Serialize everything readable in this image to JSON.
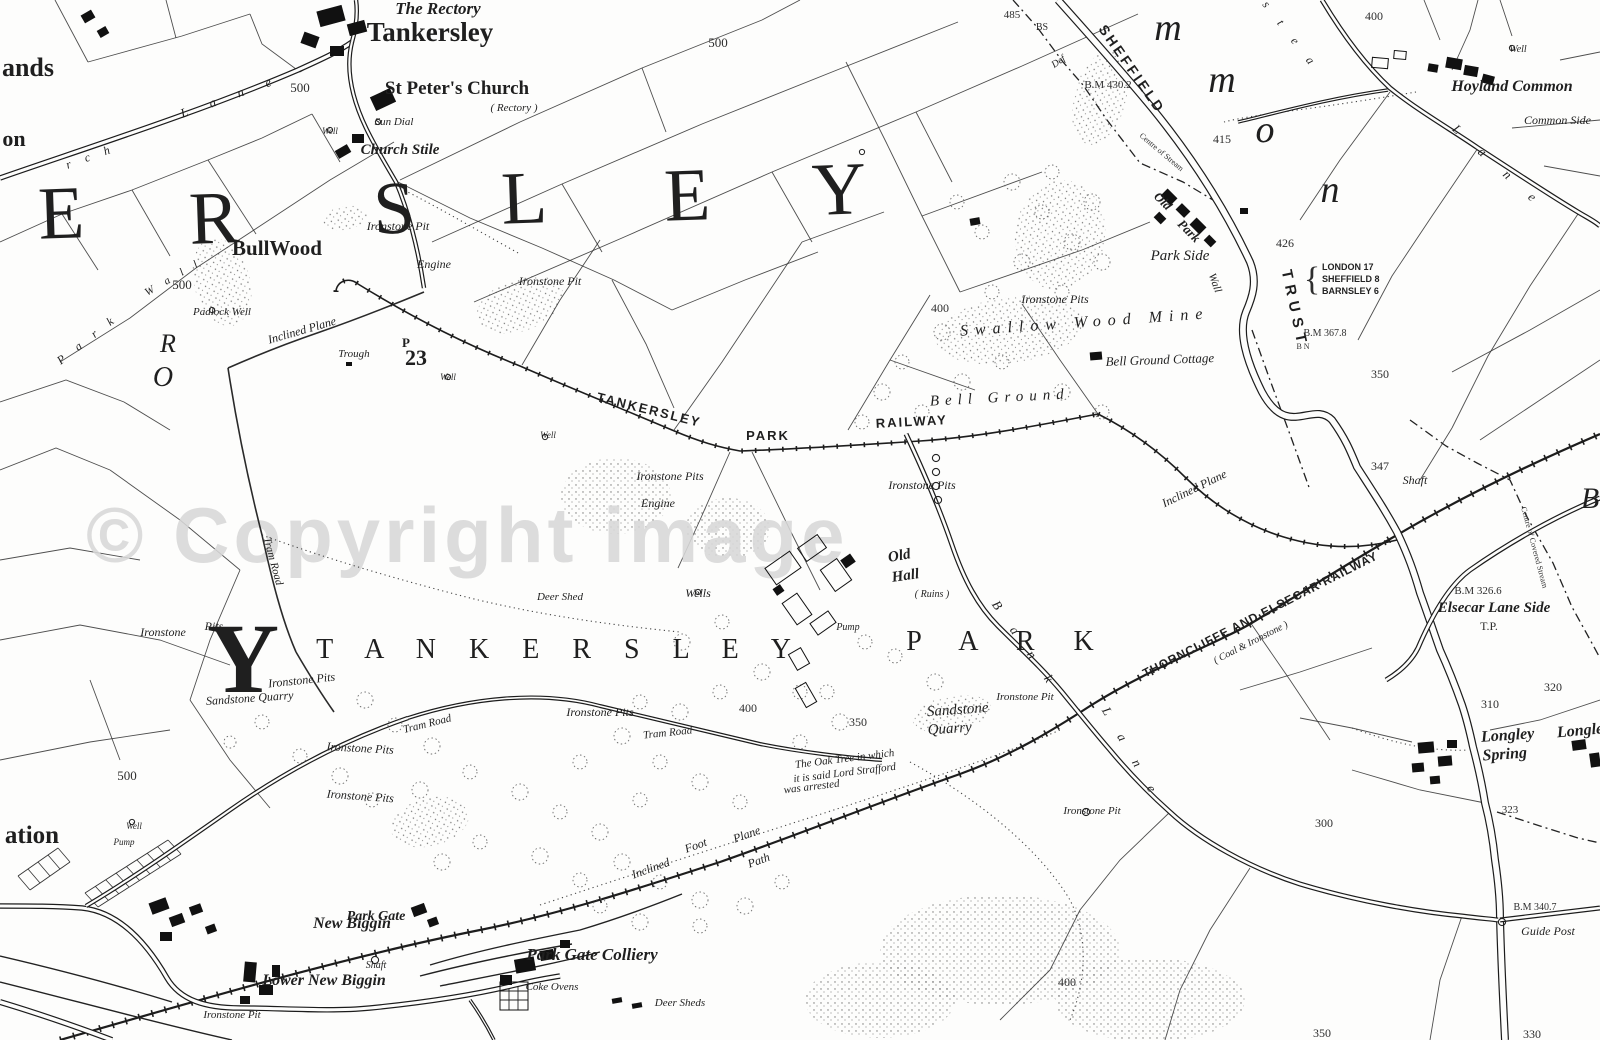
{
  "map": {
    "watermark": "© Copyright image",
    "labels": [
      {
        "t": "The Rectory",
        "x": 438,
        "y": 14,
        "s": "g",
        "f": 17
      },
      {
        "t": "Tankersley",
        "x": 430,
        "y": 41,
        "s": "n",
        "f": 27
      },
      {
        "t": "St Peter's Church",
        "x": 457,
        "y": 94,
        "s": "n",
        "f": 19
      },
      {
        "t": "( Rectory )",
        "x": 514,
        "y": 111,
        "s": "i",
        "f": 11
      },
      {
        "t": "Sun Dial",
        "x": 394,
        "y": 125,
        "s": "i",
        "f": 11
      },
      {
        "t": "Well",
        "x": 330,
        "y": 134,
        "s": "i",
        "f": 9
      },
      {
        "t": "Church Stile",
        "x": 400,
        "y": 154,
        "s": "g",
        "f": 15
      },
      {
        "t": "ands",
        "x": 28,
        "y": 76,
        "s": "n",
        "f": 26
      },
      {
        "t": "on",
        "x": 14,
        "y": 146,
        "s": "n",
        "f": 22
      },
      {
        "t": "E",
        "x": 62,
        "y": 238,
        "s": "B",
        "f": 75,
        "r": -2
      },
      {
        "t": "R",
        "x": 215,
        "y": 243,
        "s": "B",
        "f": 75,
        "r": -2
      },
      {
        "t": "S",
        "x": 395,
        "y": 233,
        "s": "B",
        "f": 75,
        "r": -2
      },
      {
        "t": "L",
        "x": 525,
        "y": 223,
        "s": "B",
        "f": 75,
        "r": -2
      },
      {
        "t": "E",
        "x": 688,
        "y": 220,
        "s": "B",
        "f": 75,
        "r": -2
      },
      {
        "t": "Y",
        "x": 840,
        "y": 214,
        "s": "B",
        "f": 75,
        "r": -2
      },
      {
        "t": "m",
        "x": 1168,
        "y": 40,
        "s": "Bi",
        "f": 38
      },
      {
        "t": "m",
        "x": 1222,
        "y": 92,
        "s": "Bi",
        "f": 38
      },
      {
        "t": "o",
        "x": 1265,
        "y": 142,
        "s": "Bi",
        "f": 38
      },
      {
        "t": "n",
        "x": 1330,
        "y": 202,
        "s": "Bi",
        "f": 38
      },
      {
        "t": "500",
        "x": 300,
        "y": 92,
        "s": "m",
        "f": 13
      },
      {
        "t": "500",
        "x": 718,
        "y": 47,
        "s": "m",
        "f": 13
      },
      {
        "t": "485",
        "x": 1012,
        "y": 18,
        "s": "m",
        "f": 11
      },
      {
        "t": "400",
        "x": 1374,
        "y": 20,
        "s": "m",
        "f": 12
      },
      {
        "t": "Well",
        "x": 1518,
        "y": 52,
        "s": "i",
        "f": 10
      },
      {
        "t": "Hoyland Common",
        "x": 1512,
        "y": 91,
        "s": "g",
        "f": 16
      },
      {
        "t": "Common Side",
        "x": 1524,
        "y": 124,
        "s": "i",
        "f": 12,
        "a": "s"
      },
      {
        "t": "BS",
        "x": 1042,
        "y": 30,
        "s": "m",
        "f": 10
      },
      {
        "t": "Def",
        "x": 1060,
        "y": 64,
        "s": "i",
        "f": 10,
        "r": -35
      },
      {
        "t": "B.M 430.2",
        "x": 1108,
        "y": 88,
        "s": "m",
        "f": 11
      },
      {
        "t": "SHEFFIELD",
        "x": 1128,
        "y": 72,
        "s": "r",
        "f": 14,
        "r": 55,
        "ls": 3
      },
      {
        "t": "415",
        "x": 1222,
        "y": 143,
        "s": "m",
        "f": 12
      },
      {
        "t": "Centre of Stream",
        "x": 1160,
        "y": 154,
        "s": "m",
        "f": 8,
        "r": 40
      },
      {
        "t": "426",
        "x": 1285,
        "y": 247,
        "s": "m",
        "f": 12
      },
      {
        "t": "TRUST",
        "x": 1290,
        "y": 310,
        "s": "r",
        "f": 15,
        "r": 78,
        "ls": 6
      },
      {
        "t": "{",
        "x": 1312,
        "y": 290,
        "s": "m",
        "f": 34
      },
      {
        "t": "LONDON 17",
        "x": 1322,
        "y": 270,
        "s": "r0",
        "f": 9,
        "a": "s"
      },
      {
        "t": "SHEFFIELD 8",
        "x": 1322,
        "y": 282,
        "s": "r0",
        "f": 9,
        "a": "s"
      },
      {
        "t": "BARNSLEY 6",
        "x": 1322,
        "y": 294,
        "s": "r0",
        "f": 9,
        "a": "s"
      },
      {
        "t": "B.M 367.8",
        "x": 1325,
        "y": 336,
        "s": "m",
        "f": 10
      },
      {
        "t": "B N",
        "x": 1303,
        "y": 349,
        "s": "m",
        "f": 8
      },
      {
        "t": "350",
        "x": 1380,
        "y": 378,
        "s": "m",
        "f": 12
      },
      {
        "t": "Old",
        "x": 1160,
        "y": 204,
        "s": "g",
        "f": 13,
        "r": 45
      },
      {
        "t": "Park",
        "x": 1186,
        "y": 234,
        "s": "g",
        "f": 13,
        "r": 45
      },
      {
        "t": "Wall",
        "x": 1212,
        "y": 284,
        "s": "i",
        "f": 11,
        "r": 70
      },
      {
        "t": "Park Side",
        "x": 1180,
        "y": 260,
        "s": "i",
        "f": 15
      },
      {
        "t": "Ironstone Pits",
        "x": 1055,
        "y": 303,
        "s": "i",
        "f": 12
      },
      {
        "t": "Swallow Wood Mine",
        "x": 1085,
        "y": 327,
        "s": "iS",
        "f": 16,
        "ls": 7,
        "r": -4
      },
      {
        "t": "Bell Ground Cottage",
        "x": 1160,
        "y": 364,
        "s": "i",
        "f": 13,
        "r": -2
      },
      {
        "t": "Bell Ground",
        "x": 1000,
        "y": 402,
        "s": "iS",
        "f": 15,
        "ls": 6,
        "r": -3
      },
      {
        "t": "400",
        "x": 940,
        "y": 312,
        "s": "m",
        "f": 12
      },
      {
        "t": "500",
        "x": 182,
        "y": 289,
        "s": "m",
        "f": 13
      },
      {
        "t": "BullWood",
        "x": 277,
        "y": 255,
        "s": "n",
        "f": 21
      },
      {
        "t": "Padlock Well",
        "x": 222,
        "y": 315,
        "s": "i",
        "f": 11
      },
      {
        "t": "R",
        "x": 168,
        "y": 352,
        "s": "Bi",
        "f": 26
      },
      {
        "t": "O",
        "x": 163,
        "y": 386,
        "s": "Bi",
        "f": 28
      },
      {
        "t": "Ironstone Pit",
        "x": 398,
        "y": 230,
        "s": "i",
        "f": 12
      },
      {
        "t": "Engine",
        "x": 434,
        "y": 268,
        "s": "i",
        "f": 12
      },
      {
        "t": "Ironstone Pit",
        "x": 550,
        "y": 285,
        "s": "i",
        "f": 12
      },
      {
        "t": "Inclined Plane",
        "x": 303,
        "y": 334,
        "s": "i",
        "f": 12,
        "r": -16
      },
      {
        "t": "Trough",
        "x": 354,
        "y": 357,
        "s": "i",
        "f": 11
      },
      {
        "t": "P",
        "x": 406,
        "y": 347,
        "s": "n",
        "f": 13
      },
      {
        "t": "23",
        "x": 416,
        "y": 365,
        "s": "n",
        "f": 22
      },
      {
        "t": "Well",
        "x": 448,
        "y": 380,
        "s": "i",
        "f": 9
      },
      {
        "t": "Well",
        "x": 548,
        "y": 438,
        "s": "i",
        "f": 9
      },
      {
        "t": "TANKERSLEY",
        "x": 648,
        "y": 414,
        "s": "r",
        "f": 13,
        "r": 14,
        "ls": 2
      },
      {
        "t": "PARK",
        "x": 768,
        "y": 440,
        "s": "r",
        "f": 13,
        "ls": 2
      },
      {
        "t": "RAILWAY",
        "x": 912,
        "y": 426,
        "s": "r",
        "f": 13,
        "r": -3,
        "ls": 2
      },
      {
        "t": "Ironstone Pits",
        "x": 670,
        "y": 480,
        "s": "i",
        "f": 12
      },
      {
        "t": "Engine",
        "x": 658,
        "y": 507,
        "s": "i",
        "f": 12
      },
      {
        "t": "Ironstone Pits",
        "x": 922,
        "y": 489,
        "s": "i",
        "f": 12
      },
      {
        "t": "Old",
        "x": 900,
        "y": 560,
        "s": "g",
        "f": 15,
        "r": -10
      },
      {
        "t": "Hall",
        "x": 906,
        "y": 580,
        "s": "g",
        "f": 15,
        "r": -8
      },
      {
        "t": "( Ruins )",
        "x": 932,
        "y": 597,
        "s": "i",
        "f": 10
      },
      {
        "t": "Wells",
        "x": 698,
        "y": 597,
        "s": "i",
        "f": 12
      },
      {
        "t": "Deer Shed",
        "x": 560,
        "y": 600,
        "s": "i",
        "f": 11
      },
      {
        "t": "Pump",
        "x": 848,
        "y": 630,
        "s": "i",
        "f": 10
      },
      {
        "t": "Y",
        "x": 243,
        "y": 692,
        "s": "Y",
        "f": 100
      },
      {
        "t": "T A N K E R S L E Y",
        "x": 560,
        "y": 658,
        "s": "S",
        "f": 28,
        "ls": 13
      },
      {
        "t": "P A R K",
        "x": 1008,
        "y": 650,
        "s": "S",
        "f": 28,
        "ls": 16
      },
      {
        "t": "Ironstone",
        "x": 163,
        "y": 636,
        "s": "i",
        "f": 12
      },
      {
        "t": "Pits",
        "x": 214,
        "y": 630,
        "s": "i",
        "f": 12
      },
      {
        "t": "Ironstone Pits",
        "x": 302,
        "y": 684,
        "s": "i",
        "f": 12,
        "r": -6
      },
      {
        "t": "Sandstone Quarry",
        "x": 250,
        "y": 702,
        "s": "i",
        "f": 12,
        "r": -4
      },
      {
        "t": "Tram Road",
        "x": 270,
        "y": 562,
        "s": "i",
        "f": 11,
        "r": 75
      },
      {
        "t": "Tram Road",
        "x": 428,
        "y": 727,
        "s": "i",
        "f": 11,
        "r": -14
      },
      {
        "t": "Tram Road",
        "x": 668,
        "y": 736,
        "s": "i",
        "f": 11,
        "r": -6
      },
      {
        "t": "Ironstone Pits",
        "x": 600,
        "y": 716,
        "s": "i",
        "f": 12
      },
      {
        "t": "400",
        "x": 748,
        "y": 712,
        "s": "m",
        "f": 12
      },
      {
        "t": "350",
        "x": 858,
        "y": 726,
        "s": "m",
        "f": 12
      },
      {
        "t": "The Oak Tree in which",
        "x": 845,
        "y": 762,
        "s": "i",
        "f": 11,
        "r": -7
      },
      {
        "t": "it is said Lord Strafford",
        "x": 845,
        "y": 776,
        "s": "i",
        "f": 11,
        "r": -7
      },
      {
        "t": "was arrested",
        "x": 812,
        "y": 790,
        "s": "i",
        "f": 11,
        "r": -7
      },
      {
        "t": "Sandstone",
        "x": 958,
        "y": 714,
        "s": "i",
        "f": 15,
        "r": -4
      },
      {
        "t": "Quarry",
        "x": 950,
        "y": 733,
        "s": "i",
        "f": 15,
        "r": -4
      },
      {
        "t": "Ironstone Pit",
        "x": 1025,
        "y": 700,
        "s": "i",
        "f": 11
      },
      {
        "t": "Ironstone Pits",
        "x": 360,
        "y": 752,
        "s": "i",
        "f": 12,
        "r": 3
      },
      {
        "t": "Foot",
        "x": 697,
        "y": 849,
        "s": "i",
        "f": 12,
        "r": -20
      },
      {
        "t": "Path",
        "x": 760,
        "y": 864,
        "s": "i",
        "f": 12,
        "r": -20
      },
      {
        "t": "Inclined",
        "x": 652,
        "y": 872,
        "s": "i",
        "f": 12,
        "r": -20
      },
      {
        "t": "Plane",
        "x": 748,
        "y": 838,
        "s": "i",
        "f": 12,
        "r": -20
      },
      {
        "t": "ation",
        "x": 32,
        "y": 843,
        "s": "n",
        "f": 25
      },
      {
        "t": "Well",
        "x": 134,
        "y": 829,
        "s": "i",
        "f": 9
      },
      {
        "t": "Pump",
        "x": 124,
        "y": 845,
        "s": "i",
        "f": 9
      },
      {
        "t": "500",
        "x": 127,
        "y": 780,
        "s": "m",
        "f": 13
      },
      {
        "t": "New Biggin",
        "x": 352,
        "y": 928,
        "s": "g",
        "f": 16
      },
      {
        "t": "Lower New Biggin",
        "x": 324,
        "y": 985,
        "s": "g",
        "f": 16
      },
      {
        "t": "Ironstone Pit",
        "x": 232,
        "y": 1018,
        "s": "i",
        "f": 11
      },
      {
        "t": "Ironstone Pits",
        "x": 360,
        "y": 800,
        "s": "i",
        "f": 12,
        "r": 4
      },
      {
        "t": "Park Gate",
        "x": 376,
        "y": 920,
        "s": "g",
        "f": 14
      },
      {
        "t": "Shaft",
        "x": 376,
        "y": 968,
        "s": "i",
        "f": 10
      },
      {
        "t": "Park Gate Colliery",
        "x": 592,
        "y": 960,
        "s": "g",
        "f": 17
      },
      {
        "t": "Coke Ovens",
        "x": 552,
        "y": 990,
        "s": "i",
        "f": 11
      },
      {
        "t": "Deer Sheds",
        "x": 680,
        "y": 1006,
        "s": "i",
        "f": 11
      },
      {
        "t": "400",
        "x": 1067,
        "y": 986,
        "s": "m",
        "f": 12
      },
      {
        "t": "Ironstone Pit",
        "x": 1092,
        "y": 814,
        "s": "i",
        "f": 11
      },
      {
        "t": "Inclined Plane",
        "x": 1196,
        "y": 492,
        "s": "i",
        "f": 12,
        "r": -26
      },
      {
        "t": "THORNCLIFFE AND ELSECAR RAILWAY",
        "x": 1262,
        "y": 618,
        "s": "r",
        "f": 12,
        "r": -27,
        "ls": 1
      },
      {
        "t": "( Coal & Ironstone )",
        "x": 1252,
        "y": 645,
        "s": "i",
        "f": 10,
        "r": -27
      },
      {
        "t": "347",
        "x": 1380,
        "y": 470,
        "s": "m",
        "f": 12
      },
      {
        "t": "Shaft",
        "x": 1415,
        "y": 484,
        "s": "i",
        "f": 12
      },
      {
        "t": "B.M 326.6",
        "x": 1478,
        "y": 594,
        "s": "m",
        "f": 11
      },
      {
        "t": "Elsecar Lane Side",
        "x": 1494,
        "y": 612,
        "s": "g",
        "f": 15
      },
      {
        "t": "T.P.",
        "x": 1489,
        "y": 630,
        "s": "m",
        "f": 12
      },
      {
        "t": "B",
        "x": 1590,
        "y": 508,
        "s": "Bi",
        "f": 30
      },
      {
        "t": "Centre of Covered Stream",
        "x": 1532,
        "y": 548,
        "s": "m",
        "f": 8,
        "r": 75
      },
      {
        "t": "Longley",
        "x": 1508,
        "y": 740,
        "s": "g",
        "f": 16,
        "r": -4
      },
      {
        "t": "Spring",
        "x": 1505,
        "y": 759,
        "s": "g",
        "f": 16,
        "r": -4
      },
      {
        "t": "Longley",
        "x": 1584,
        "y": 735,
        "s": "g",
        "f": 16,
        "r": -5
      },
      {
        "t": "310",
        "x": 1490,
        "y": 708,
        "s": "m",
        "f": 12
      },
      {
        "t": "320",
        "x": 1553,
        "y": 691,
        "s": "m",
        "f": 12
      },
      {
        "t": "300",
        "x": 1324,
        "y": 827,
        "s": "m",
        "f": 12
      },
      {
        "t": "323",
        "x": 1510,
        "y": 813,
        "s": "m",
        "f": 11
      },
      {
        "t": "B.M 340.7",
        "x": 1535,
        "y": 910,
        "s": "m",
        "f": 10
      },
      {
        "t": "Guide Post",
        "x": 1548,
        "y": 935,
        "s": "i",
        "f": 12
      },
      {
        "t": "350",
        "x": 1322,
        "y": 1037,
        "s": "m",
        "f": 12
      },
      {
        "t": "330",
        "x": 1532,
        "y": 1038,
        "s": "m",
        "f": 12
      },
      {
        "t": "B a n k",
        "x": 1022,
        "y": 648,
        "s": "i",
        "f": 13,
        "r": 55,
        "ls": 10
      },
      {
        "t": "L a n e",
        "x": 1128,
        "y": 756,
        "s": "i",
        "f": 13,
        "r": 60,
        "ls": 10
      },
      {
        "t": "L a n e",
        "x": 1496,
        "y": 170,
        "s": "i",
        "f": 13,
        "r": 42,
        "ls": 12
      },
      {
        "t": "s t e a",
        "x": 1288,
        "y": 38,
        "s": "i",
        "f": 12,
        "r": 52,
        "ls": 8
      },
      {
        "t": "r c h",
        "x": 92,
        "y": 160,
        "s": "i",
        "f": 12,
        "r": -20,
        "ls": 6
      },
      {
        "t": "L a n e",
        "x": 232,
        "y": 100,
        "s": "i",
        "f": 13,
        "r": -20,
        "ls": 10
      },
      {
        "t": "P a r k",
        "x": 90,
        "y": 342,
        "s": "i",
        "f": 12,
        "r": -38,
        "ls": 6
      },
      {
        "t": "W a l l",
        "x": 175,
        "y": 280,
        "s": "i",
        "f": 11,
        "r": -30,
        "ls": 5
      }
    ]
  }
}
